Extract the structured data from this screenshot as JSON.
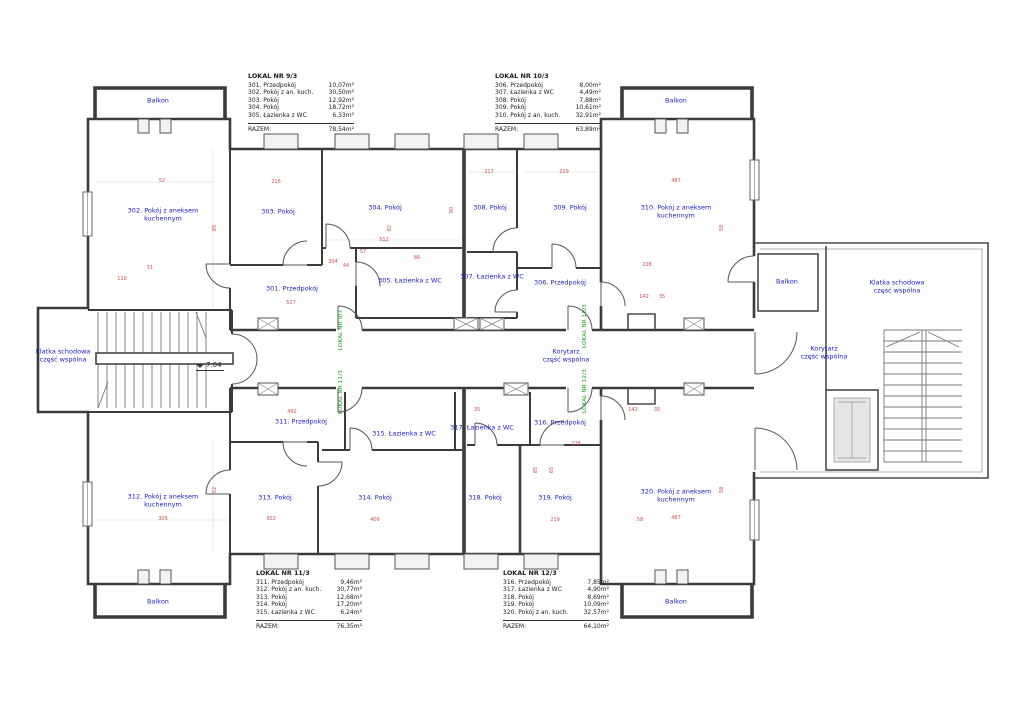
{
  "palette": {
    "room_label": "#1a1acc",
    "dimension": "#c95050",
    "lokal_tag": "#12a012",
    "wall": "#3b3b3b"
  },
  "legends": [
    {
      "title": "LOKAL NR 9/3",
      "rows": [
        [
          "301. Przedpokój",
          "10,07m²"
        ],
        [
          "302. Pokój z an. kuch.",
          "30,50m²"
        ],
        [
          "303. Pokój",
          "12,92m²"
        ],
        [
          "304. Pokój",
          "18,72m²"
        ],
        [
          "305. Łazienka z WC",
          "6,33m²"
        ]
      ],
      "razem_label": "RAZEM:",
      "razem": "78,54m²"
    },
    {
      "title": "LOKAL NR 10/3",
      "rows": [
        [
          "306. Przedpokój",
          "8,00m²"
        ],
        [
          "307. Łazienka z WC",
          "4,49m²"
        ],
        [
          "308. Pokój",
          "7,88m²"
        ],
        [
          "309. Pokój",
          "10,61m²"
        ],
        [
          "310. Pokój z an. kuch.",
          "32,91m²"
        ]
      ],
      "razem_label": "RAZEM:",
      "razem": "63,89m²"
    },
    {
      "title": "LOKAL NR 11/3",
      "rows": [
        [
          "311. Przedpokój",
          "9,46m²"
        ],
        [
          "312. Pokój z an. kuch.",
          "30,77m²"
        ],
        [
          "313. Pokój",
          "12,68m²"
        ],
        [
          "314. Pokój",
          "17,20m²"
        ],
        [
          "315. Łazienka z WC",
          "6,24m²"
        ]
      ],
      "razem_label": "RAZEM:",
      "razem": "76,35m²"
    },
    {
      "title": "LOKAL NR 12/3",
      "rows": [
        [
          "316. Przedpokój",
          "7,85m²"
        ],
        [
          "317. Łazienka z WC",
          "4,90m²"
        ],
        [
          "318. Pokój",
          "8,69m²"
        ],
        [
          "319. Pokój",
          "10,09m²"
        ],
        [
          "320. Pokój z an. kuch.",
          "32,57m²"
        ]
      ],
      "razem_label": "RAZEM:",
      "razem": "64,10m²"
    }
  ],
  "plan": {
    "level": {
      "t": "7.04",
      "x": 196,
      "y": 361
    },
    "rooms": [
      {
        "t": "301. Przedpokój",
        "x": 292,
        "y": 289
      },
      {
        "t": "302. Pokój z aneksem\nkuchennym",
        "x": 163,
        "y": 215
      },
      {
        "t": "303. Pokój",
        "x": 278,
        "y": 212
      },
      {
        "t": "304. Pokój",
        "x": 385,
        "y": 208
      },
      {
        "t": "305. Łazienka z WC",
        "x": 410,
        "y": 281
      },
      {
        "t": "306. Przedpokój",
        "x": 560,
        "y": 283
      },
      {
        "t": "307. Łazienka z WC",
        "x": 492,
        "y": 277
      },
      {
        "t": "308. Pokój",
        "x": 490,
        "y": 208
      },
      {
        "t": "309. Pokój",
        "x": 570,
        "y": 208
      },
      {
        "t": "310. Pokój z aneksem\nkuchennym",
        "x": 676,
        "y": 212
      },
      {
        "t": "311. Przedpokój",
        "x": 301,
        "y": 422
      },
      {
        "t": "312. Pokój z aneksem\nkuchennym",
        "x": 163,
        "y": 501
      },
      {
        "t": "313. Pokój",
        "x": 275,
        "y": 498
      },
      {
        "t": "314. Pokój",
        "x": 375,
        "y": 498
      },
      {
        "t": "315. Łazienka z WC",
        "x": 404,
        "y": 434
      },
      {
        "t": "316. Przedpokój",
        "x": 560,
        "y": 423
      },
      {
        "t": "317. Łazienka z WC",
        "x": 482,
        "y": 428
      },
      {
        "t": "318. Pokój",
        "x": 485,
        "y": 498
      },
      {
        "t": "319. Pokój",
        "x": 555,
        "y": 498
      },
      {
        "t": "320. Pokój z aneksem\nkuchennym",
        "x": 676,
        "y": 496
      }
    ],
    "zones": [
      {
        "t": "Balkon",
        "x": 158,
        "y": 101
      },
      {
        "t": "Balkon",
        "x": 676,
        "y": 101
      },
      {
        "t": "Balkon",
        "x": 158,
        "y": 602
      },
      {
        "t": "Balkon",
        "x": 676,
        "y": 602
      },
      {
        "t": "Balkon",
        "x": 787,
        "y": 282
      },
      {
        "t": "Klatka schodowa\nczęść wspólna",
        "x": 63,
        "y": 356
      },
      {
        "t": "Klatka schodowa\nczęść wspólna",
        "x": 897,
        "y": 287
      },
      {
        "t": "Korytarz\nczęść wspólna",
        "x": 566,
        "y": 356
      },
      {
        "t": "Korytarz\nczęść wspólna",
        "x": 824,
        "y": 353
      }
    ],
    "lokale": [
      {
        "t": "LOKAL NR 9/3",
        "x": 341,
        "y": 330
      },
      {
        "t": "LOKAL NR 10/3",
        "x": 585,
        "y": 326
      },
      {
        "t": "LOKAL NR 11/3",
        "x": 341,
        "y": 392
      },
      {
        "t": "LOKAL NR 12/3",
        "x": 585,
        "y": 391
      }
    ],
    "dims": [
      {
        "t": "52",
        "x": 162,
        "y": 181
      },
      {
        "t": "216",
        "x": 276,
        "y": 182
      },
      {
        "t": "217",
        "x": 489,
        "y": 172
      },
      {
        "t": "219",
        "x": 564,
        "y": 172
      },
      {
        "t": "487",
        "x": 676,
        "y": 181
      },
      {
        "t": "85",
        "x": 215,
        "y": 228,
        "v": 1
      },
      {
        "t": "82",
        "x": 390,
        "y": 228,
        "v": 1
      },
      {
        "t": "90",
        "x": 452,
        "y": 210,
        "v": 1
      },
      {
        "t": "58",
        "x": 722,
        "y": 228,
        "v": 1
      },
      {
        "t": "512",
        "x": 384,
        "y": 240
      },
      {
        "t": "304",
        "x": 333,
        "y": 262
      },
      {
        "t": "110",
        "x": 122,
        "y": 279
      },
      {
        "t": "51",
        "x": 150,
        "y": 268
      },
      {
        "t": "527",
        "x": 291,
        "y": 303
      },
      {
        "t": "44",
        "x": 346,
        "y": 266
      },
      {
        "t": "57",
        "x": 363,
        "y": 252
      },
      {
        "t": "86",
        "x": 417,
        "y": 258
      },
      {
        "t": "228",
        "x": 647,
        "y": 265
      },
      {
        "t": "142",
        "x": 644,
        "y": 297
      },
      {
        "t": "35",
        "x": 662,
        "y": 297
      },
      {
        "t": "305",
        "x": 163,
        "y": 519
      },
      {
        "t": "52",
        "x": 215,
        "y": 490,
        "v": 1
      },
      {
        "t": "492",
        "x": 292,
        "y": 412
      },
      {
        "t": "302",
        "x": 271,
        "y": 519
      },
      {
        "t": "406",
        "x": 375,
        "y": 520
      },
      {
        "t": "219",
        "x": 555,
        "y": 520
      },
      {
        "t": "487",
        "x": 676,
        "y": 518
      },
      {
        "t": "58",
        "x": 640,
        "y": 520
      },
      {
        "t": "228",
        "x": 576,
        "y": 444
      },
      {
        "t": "85",
        "x": 536,
        "y": 470,
        "v": 1
      },
      {
        "t": "65",
        "x": 552,
        "y": 470,
        "v": 1
      },
      {
        "t": "142",
        "x": 633,
        "y": 410
      },
      {
        "t": "35",
        "x": 657,
        "y": 410
      },
      {
        "t": "35",
        "x": 477,
        "y": 410
      },
      {
        "t": "58",
        "x": 722,
        "y": 490,
        "v": 1
      }
    ]
  }
}
